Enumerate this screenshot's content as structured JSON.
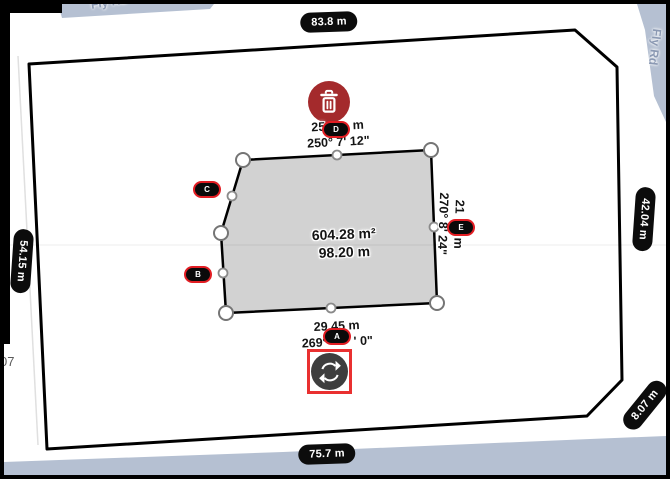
{
  "map": {
    "road_top_label": "Fly Rd",
    "road_right_label": "Fly Rd",
    "parcel_number_partial": "07",
    "road_color": "#b5c0d2"
  },
  "boundary_measurements": {
    "top": "83.8 m",
    "left": "54.15 m",
    "right": "42.04 m",
    "bottom": "75.7 m",
    "corner": "8.07 m"
  },
  "plot": {
    "fill_color": "#d2d2d2",
    "area": "604.28 m²",
    "length": "98.20 m",
    "edge_top": {
      "length_prefix": "25.",
      "length_suffix": "m",
      "bearing": "250° 7' 12\""
    },
    "edge_right": {
      "length_prefix": "21",
      "length_suffix": "m",
      "bearing": "270° 8' 24\""
    },
    "edge_bottom": {
      "length": "29.45 m",
      "bearing_prefix": "269°",
      "bearing_suffix": "' 0\""
    },
    "points": {
      "a": "A",
      "b": "B",
      "c": "C",
      "d": "D",
      "e": "E"
    }
  },
  "controls": {
    "delete_color": "#a42a2c",
    "badge_border_color": "#e21d23",
    "rotate_outline_color": "#e93030",
    "rotate_circle_color": "#3e3e3e"
  }
}
